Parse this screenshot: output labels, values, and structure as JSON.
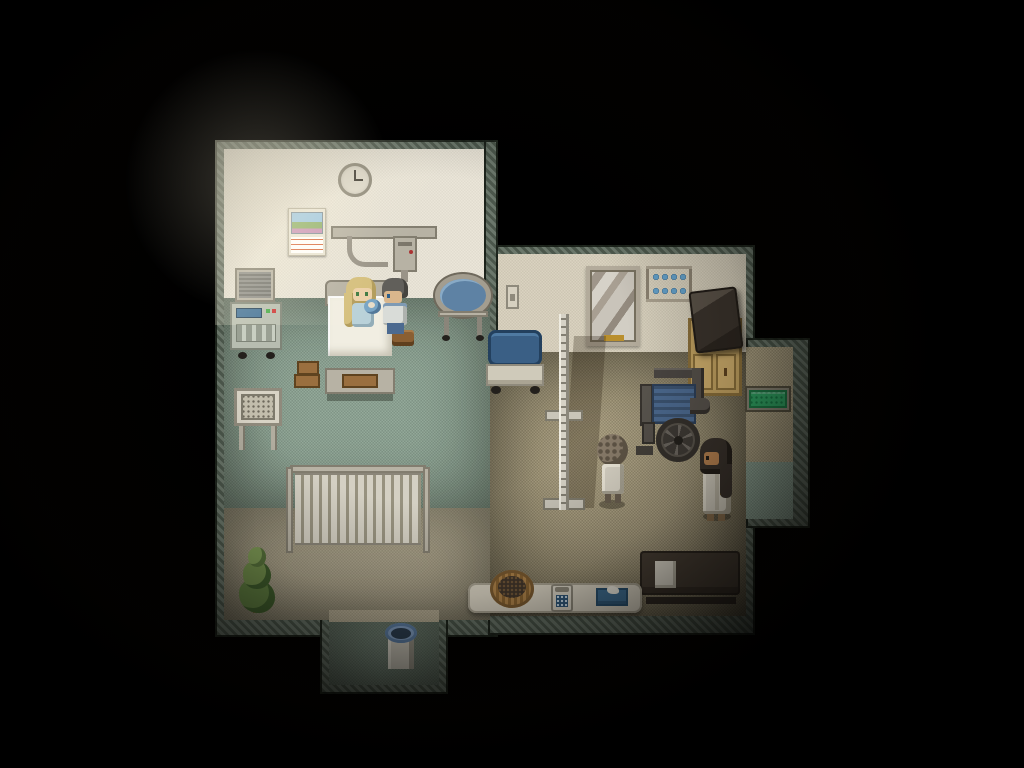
{
  "meta": {
    "scene_label": "top-down pixel-art hospital room at night",
    "style": "retro RPG interior, dark vignette, warm lamp light from upper-left"
  },
  "clock": {
    "time_shown": "3:00"
  },
  "palette": {
    "wallBorder": "#5c6a5c",
    "wallWhite": "#eae5d7",
    "wallBeige": "#d8d1bd",
    "carpet": "#8ea595",
    "floor": "#aca081",
    "stripBeige": "#b3aa90",
    "metal": "#b7b2a4",
    "metalDark": "#827d6f",
    "sheet": "#f1eee2",
    "crate": "#9a6f3f",
    "blueMattress": "#3a5f85",
    "gurneyBase": "#cfcaba",
    "blueCup": "#64a0c8",
    "tvDark": "#3a332c",
    "cabinetTan": "#c2a261",
    "greenMat": "#2fa564",
    "plantGreen": "#5e7d40",
    "plantDark": "#3e5c2c",
    "hairBlonde": "#d5bf7d",
    "hairGray": "#615f5a",
    "hairDark": "#37302a",
    "hairCurly": "#897c6a",
    "skinLight": "#ecd0a8",
    "skinTan": "#b5804f",
    "gownBlue": "#b9d1d9",
    "babyBlue": "#79a5c5",
    "shirtLight": "#d9dcd8",
    "pantsBlue": "#4c6a90",
    "robe": "#d2cdbf",
    "trimGold": "#c9a43e",
    "benchDark": "#473e34",
    "basket": "#ad8249",
    "basketDark": "#41352a",
    "trashBlue": "#84a2c6",
    "phoneBlue": "#2e577a",
    "tissueBlue": "#3f6f94",
    "clockFace": "#dbd6c8",
    "displayBlue": "#3d6e96",
    "mirrorGold": "#b98f2e"
  },
  "labels": {
    "clock": "wall clock (3:00)",
    "calendar": "wall calendar with meadow picture",
    "overbedArm": "over-bed swing arm fixture",
    "monitor": "vital-signs monitor cart",
    "bed": "hospital bed with white sheets",
    "mother": "blonde woman in bed holding baby",
    "father": "gray-haired man sitting on stool",
    "bassinet": "baby bassinet on wheeled stand",
    "crates": "stacked wooden boxes",
    "trayTable": "bedside tray table",
    "radiator": "wall radiator",
    "plant": "potted evergreen plant",
    "trashCan": "waste bin with blue liner",
    "lightSwitch": "light switch",
    "mirror": "tall wall mirror",
    "cupShelf": "shelf with blue cups",
    "tv": "television set",
    "cabinet": "wooden cabinet",
    "gurney": "blue stretcher gurney",
    "parallelBar": "physical-therapy walking rail",
    "wheelchair": "wheelchair",
    "elderlyPatient": "short curly-haired patient in white",
    "darkHairedWoman": "long dark-haired woman in pale robe",
    "greenMat": "green exit door mat",
    "bench": "dark waiting bench with paper",
    "counter": "low white counter",
    "basket": "round wicker basket",
    "phone": "telephone with blue keypad",
    "tissueBox": "blue tissue box"
  },
  "characters": [
    {
      "id": "mother-in-bed",
      "desc": "blonde woman sitting up in hospital bed holding a baby in a blue blanket"
    },
    {
      "id": "father-on-stool",
      "desc": "gray-haired man in light shirt sitting on a wooden stool beside the bed"
    },
    {
      "id": "elderly-patient",
      "desc": "short person with curly gray-brown hair wearing white, standing near the walking rail"
    },
    {
      "id": "dark-haired-woman",
      "desc": "woman with long dark hair in a pale robe with gold trim, facing the wheelchair"
    }
  ]
}
